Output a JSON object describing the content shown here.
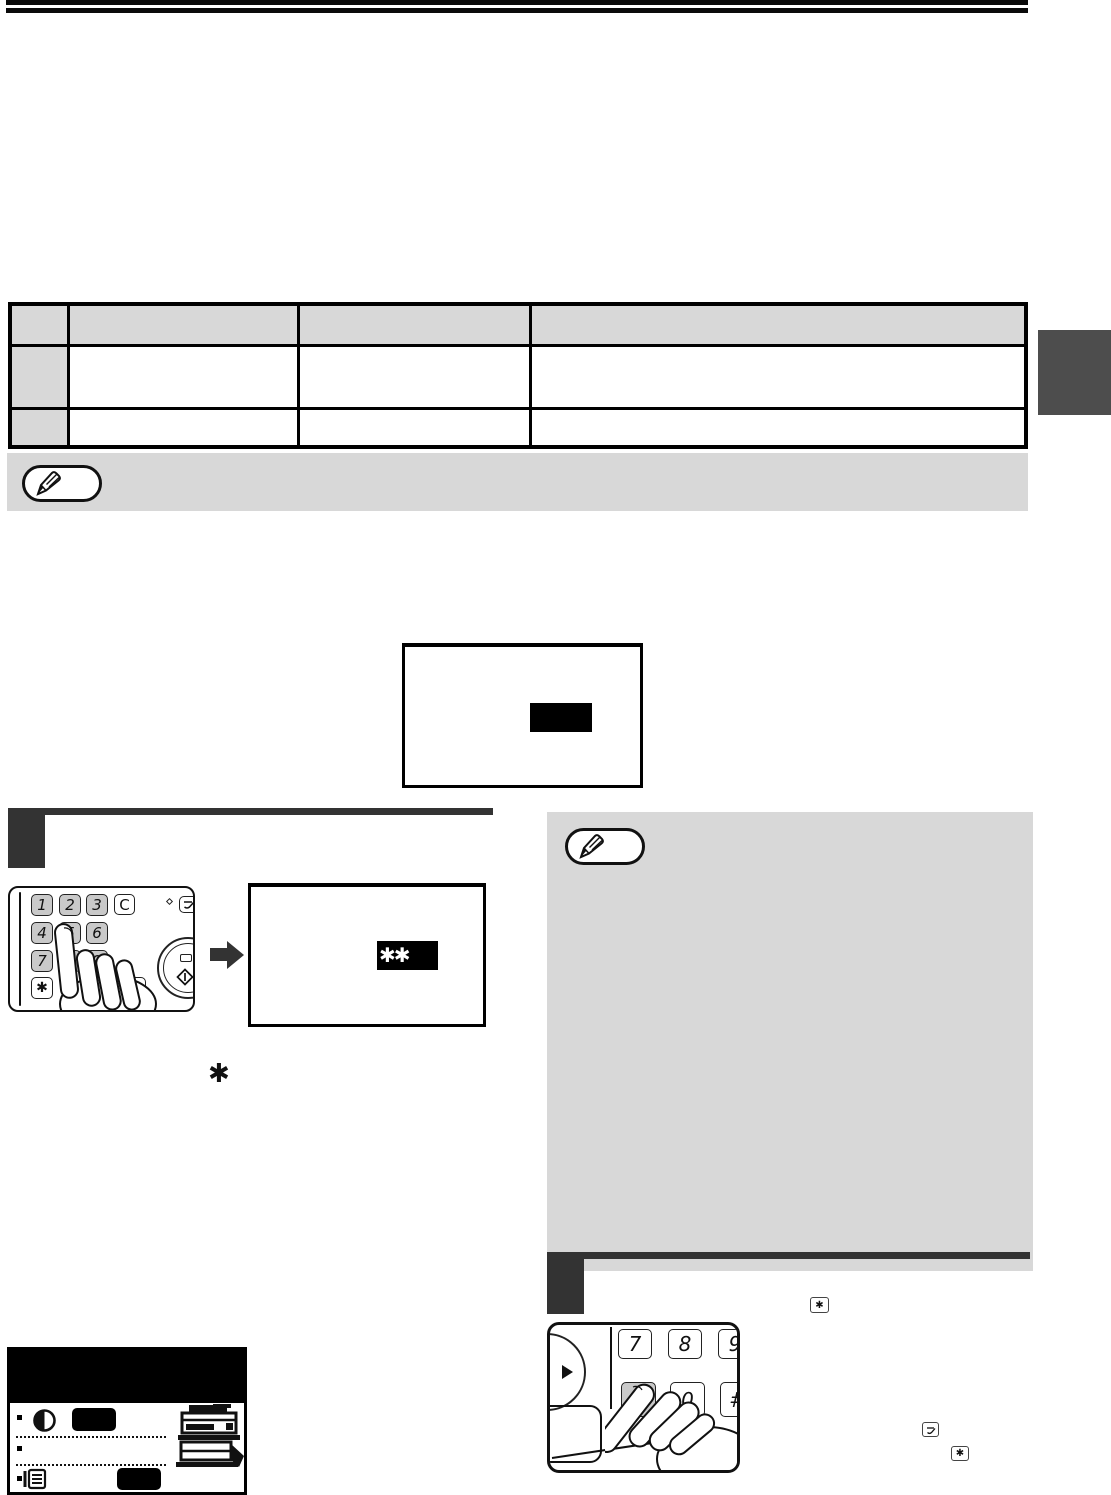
{
  "page": {
    "type": "copier-operation-manual-page",
    "colors": {
      "ink": "#111111",
      "bar_black": "#0a0a0a",
      "step_dark": "#333333",
      "tab_dark": "#4d4d4d",
      "panel_gray": "#d8d8d8",
      "key_gray": "#c9c9c9",
      "display_black": "#000000"
    }
  },
  "keypad1": {
    "keys": {
      "one": "1",
      "two": "2",
      "three": "3",
      "clear": "C",
      "four": "4",
      "five": "5",
      "six": "6",
      "seven": "7",
      "eight": "8",
      "nine": "9",
      "star": "✱",
      "hash": "#",
      "clear_all": "CA"
    }
  },
  "keypad2": {
    "keys": {
      "seven": "7",
      "eight": "8",
      "nine": "9",
      "star": "✱",
      "zero": "0",
      "hash": "#"
    }
  },
  "display": {
    "entered_value": "✱✱"
  },
  "inline_symbols": {
    "asterisk": "✱",
    "star_key": "✱",
    "star_key_2": "✱"
  },
  "icons": {
    "note": "pencil-icon",
    "audit": "audit-key-icon",
    "start": "start-diamond-icon",
    "arrow": "right-arrow-icon",
    "contrast": "contrast-icon",
    "list": "list-icon",
    "copier": "copier-icon"
  }
}
